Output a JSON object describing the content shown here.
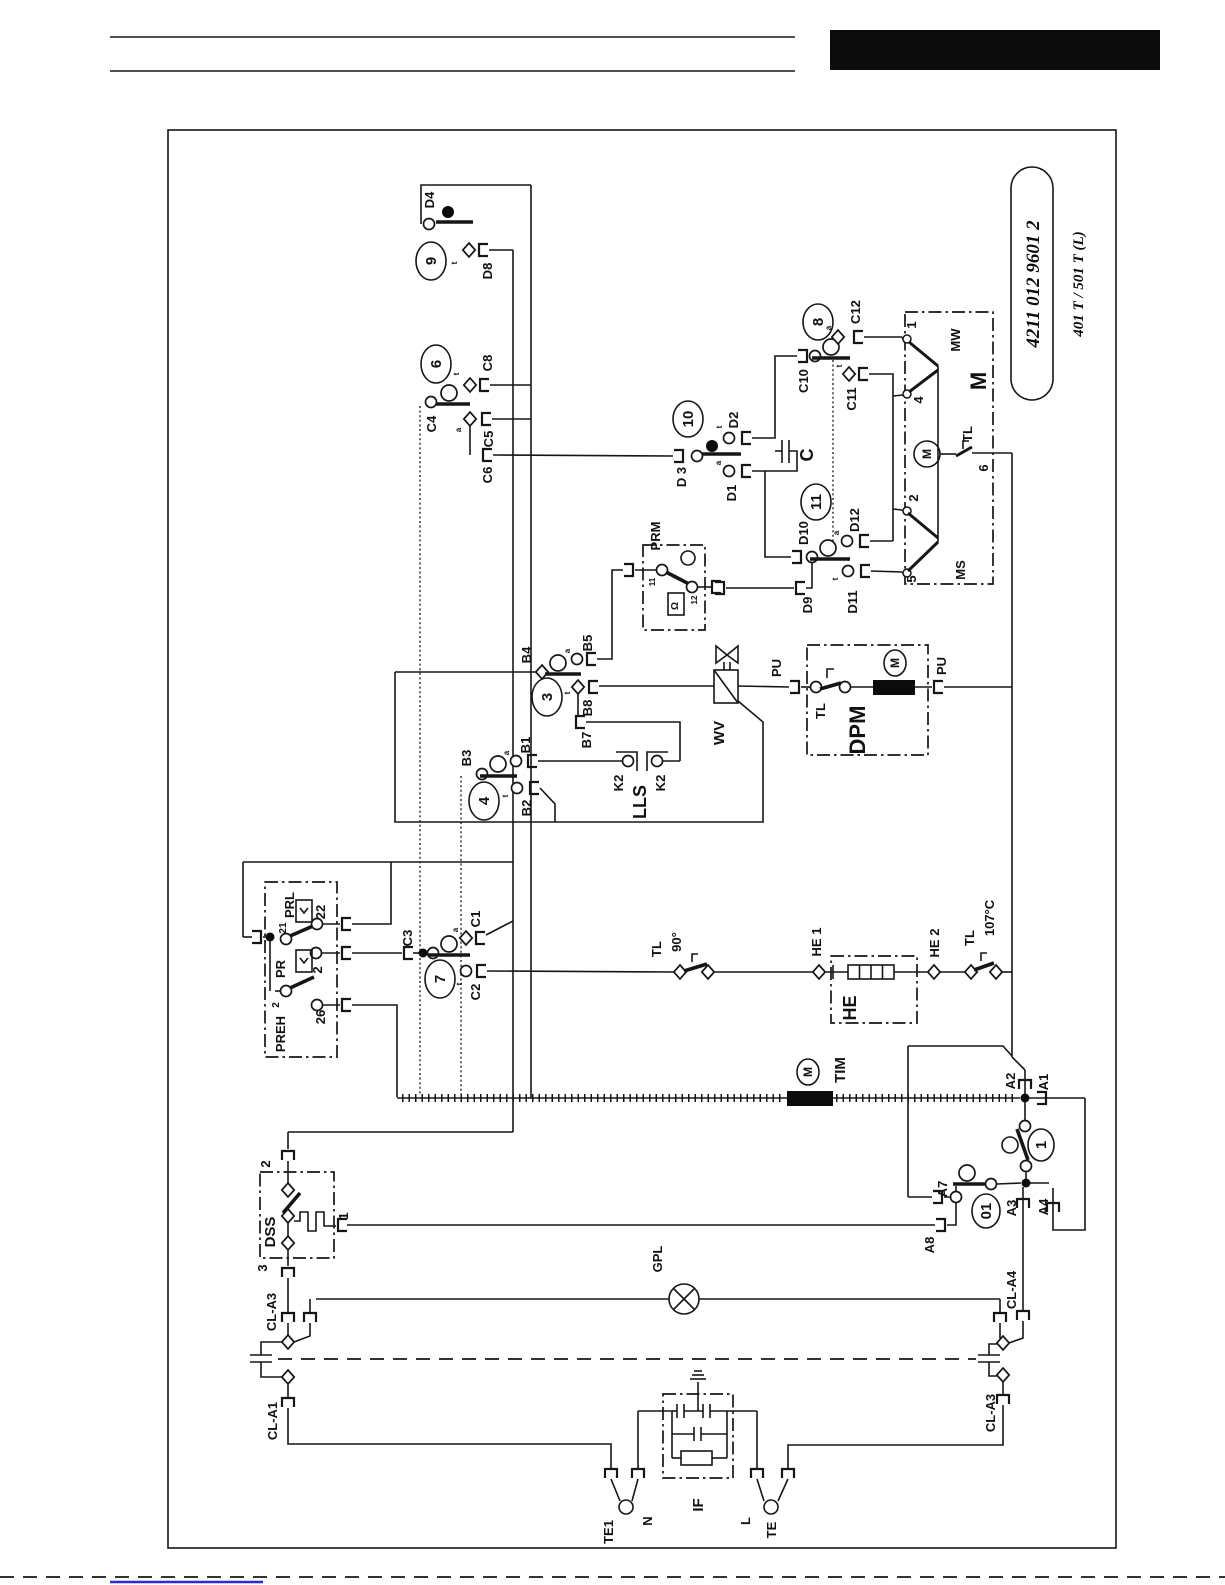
{
  "page": {
    "part_number": "4211 012 9601 2",
    "model": "401 T / 501 T (L)"
  },
  "labels": {
    "d4": "D4",
    "n9": "9",
    "d8": "D8",
    "n6": "6",
    "c8": "C8",
    "c4": "C4",
    "c5": "C5",
    "c6": "C6",
    "n8": "8",
    "c12": "C12",
    "c10": "C10",
    "c11": "C11",
    "mw": "MW",
    "m_big": "M",
    "tl_motor": "TL",
    "m_motor": "M",
    "t1": "1",
    "t4": "4",
    "t2": "2",
    "t5": "5",
    "t6": "6",
    "ms": "MS",
    "n10": "10",
    "d3": "D 3",
    "d2": "D2",
    "d1": "D1",
    "cap_c": "C",
    "n11": "11",
    "d10": "D10",
    "d12": "D12",
    "d9": "D9",
    "d11": "D11",
    "prm": "PRM",
    "prm_11": "11",
    "prm_12": "12",
    "prm_sym": "Ω",
    "b4": "B4",
    "b5": "B5",
    "n3": "3",
    "b8": "B8",
    "b7": "B7",
    "wv": "WV",
    "pu_l": "PU",
    "pu_r": "PU",
    "tl_dpm": "TL",
    "dpm": "DPM",
    "m_dpm": "M",
    "b3": "B3",
    "b1": "B1",
    "k2_l": "K2",
    "k2_r": "K2",
    "lls": "LLS",
    "n4": "4",
    "b2": "B2",
    "preh": "PREH",
    "prl": "PRL",
    "pr": "PR",
    "t21": "21",
    "t22": "22",
    "t2_pr": "2",
    "t2_com": "2",
    "t26": "26",
    "c3": "C3",
    "c1": "C1",
    "n7": "7",
    "c2": "C2",
    "tl90": "TL",
    "deg90": "90°",
    "he1": "HE 1",
    "he2": "HE 2",
    "he": "HE",
    "tl107": "TL",
    "deg107": "107°C",
    "tim": "TIM",
    "m_tim": "M",
    "a2": "A2",
    "a1": "A1",
    "n1": "1",
    "a7": "A7",
    "n01": "01",
    "a3": "A3",
    "a4": "A4",
    "a8": "A8",
    "dss": "DSS",
    "dss2": "2",
    "dss1": "1",
    "dss3": "3",
    "cl_a3_l": "CL-A3",
    "cl_a1": "CL-A1",
    "gpl": "GPL",
    "cl_a4": "CL-A4",
    "cl_a3_r": "CL-A3",
    "if": "IF",
    "te1": "TE1",
    "n_term": "N",
    "l_term": "L",
    "te": "TE",
    "tick_t": "t",
    "tick_a": "a"
  }
}
